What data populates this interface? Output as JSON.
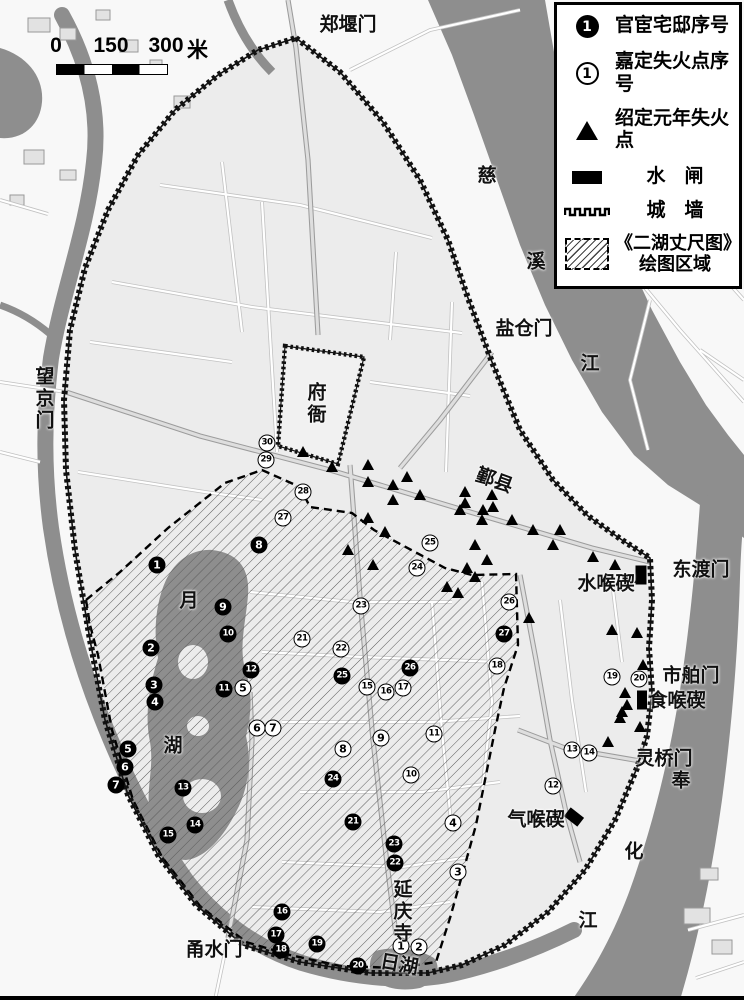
{
  "colors": {
    "ink": "#000000",
    "river": "#8e8e8e",
    "land": "#f8f8f8",
    "city": "#ececec",
    "label": "#111111"
  },
  "legend": {
    "items": [
      {
        "id": "official",
        "symbol": "filled-circle",
        "symbol_text": "1",
        "label": "官宦宅邸序号"
      },
      {
        "id": "jiading",
        "symbol": "open-circle",
        "symbol_text": "1",
        "label": "嘉定失火点序号"
      },
      {
        "id": "shaoding",
        "symbol": "triangle",
        "label": "绍定元年失火点"
      },
      {
        "id": "sluice",
        "symbol": "black-bar",
        "label": "水　闸"
      },
      {
        "id": "wall",
        "symbol": "crenellation",
        "label": "城　墙"
      },
      {
        "id": "map-area",
        "symbol": "hatched-box",
        "label": "《二湖丈尺图》",
        "label2": "绘图区域"
      }
    ]
  },
  "scalebar": {
    "ticks": [
      "0",
      "150",
      "300"
    ],
    "unit": "米"
  },
  "map": {
    "labels": [
      {
        "text": "郑堰门",
        "x": 348,
        "y": 26,
        "o": "h"
      },
      {
        "text": "望京门",
        "x": 42,
        "y": 399,
        "o": "v"
      },
      {
        "text": "慈",
        "x": 487,
        "y": 177,
        "o": "h"
      },
      {
        "text": "溪",
        "x": 536,
        "y": 263,
        "o": "h"
      },
      {
        "text": "江",
        "x": 590,
        "y": 365,
        "o": "h"
      },
      {
        "text": "盐仓门",
        "x": 524,
        "y": 330,
        "o": "h"
      },
      {
        "text": "府衙",
        "x": 314,
        "y": 404,
        "o": "v"
      },
      {
        "text": "鄞县",
        "x": 494,
        "y": 482,
        "o": "h",
        "rot": 20
      },
      {
        "text": "东渡门",
        "x": 701,
        "y": 571,
        "o": "h"
      },
      {
        "text": "水喉碶",
        "x": 606,
        "y": 585,
        "o": "h"
      },
      {
        "text": "市舶门",
        "x": 691,
        "y": 677,
        "o": "h"
      },
      {
        "text": "食喉碶",
        "x": 677,
        "y": 702,
        "o": "h"
      },
      {
        "text": "灵桥门",
        "x": 664,
        "y": 760,
        "o": "h"
      },
      {
        "text": "奉",
        "x": 681,
        "y": 782,
        "o": "h"
      },
      {
        "text": "化",
        "x": 634,
        "y": 853,
        "o": "h"
      },
      {
        "text": "江",
        "x": 588,
        "y": 922,
        "o": "h"
      },
      {
        "text": "气喉碶",
        "x": 536,
        "y": 821,
        "o": "h"
      },
      {
        "text": "月",
        "x": 189,
        "y": 602,
        "o": "h"
      },
      {
        "text": "湖",
        "x": 173,
        "y": 747,
        "o": "h"
      },
      {
        "text": "延庆寺",
        "x": 400,
        "y": 912,
        "o": "v"
      },
      {
        "text": "日湖",
        "x": 399,
        "y": 966,
        "o": "h",
        "rot": 10
      },
      {
        "text": "甬水门",
        "x": 214,
        "y": 951,
        "o": "h"
      }
    ],
    "official_residences": [
      {
        "n": 1,
        "x": 157,
        "y": 565
      },
      {
        "n": 2,
        "x": 151,
        "y": 648
      },
      {
        "n": 3,
        "x": 154,
        "y": 685
      },
      {
        "n": 4,
        "x": 155,
        "y": 702
      },
      {
        "n": 5,
        "x": 128,
        "y": 749
      },
      {
        "n": 6,
        "x": 125,
        "y": 767
      },
      {
        "n": 7,
        "x": 116,
        "y": 785
      },
      {
        "n": 8,
        "x": 259,
        "y": 545
      },
      {
        "n": 9,
        "x": 223,
        "y": 607
      },
      {
        "n": 10,
        "x": 228,
        "y": 634
      },
      {
        "n": 11,
        "x": 224,
        "y": 689
      },
      {
        "n": 12,
        "x": 251,
        "y": 670
      },
      {
        "n": 13,
        "x": 183,
        "y": 788
      },
      {
        "n": 14,
        "x": 195,
        "y": 825
      },
      {
        "n": 15,
        "x": 168,
        "y": 835
      },
      {
        "n": 16,
        "x": 282,
        "y": 912
      },
      {
        "n": 17,
        "x": 276,
        "y": 935
      },
      {
        "n": 18,
        "x": 281,
        "y": 950
      },
      {
        "n": 19,
        "x": 317,
        "y": 944
      },
      {
        "n": 20,
        "x": 358,
        "y": 966
      },
      {
        "n": 21,
        "x": 353,
        "y": 822
      },
      {
        "n": 22,
        "x": 395,
        "y": 863
      },
      {
        "n": 23,
        "x": 394,
        "y": 844
      },
      {
        "n": 24,
        "x": 333,
        "y": 779
      },
      {
        "n": 25,
        "x": 342,
        "y": 676
      },
      {
        "n": 26,
        "x": 410,
        "y": 668
      },
      {
        "n": 27,
        "x": 504,
        "y": 634
      }
    ],
    "jiading_fire_points": [
      {
        "n": 1,
        "x": 401,
        "y": 946
      },
      {
        "n": 2,
        "x": 419,
        "y": 947
      },
      {
        "n": 3,
        "x": 458,
        "y": 872
      },
      {
        "n": 4,
        "x": 453,
        "y": 823
      },
      {
        "n": 5,
        "x": 243,
        "y": 688
      },
      {
        "n": 6,
        "x": 257,
        "y": 728
      },
      {
        "n": 7,
        "x": 273,
        "y": 728
      },
      {
        "n": 8,
        "x": 343,
        "y": 749
      },
      {
        "n": 9,
        "x": 381,
        "y": 738
      },
      {
        "n": 10,
        "x": 411,
        "y": 775
      },
      {
        "n": 11,
        "x": 434,
        "y": 734
      },
      {
        "n": 12,
        "x": 553,
        "y": 786
      },
      {
        "n": 13,
        "x": 572,
        "y": 750
      },
      {
        "n": 14,
        "x": 589,
        "y": 753
      },
      {
        "n": 15,
        "x": 367,
        "y": 687
      },
      {
        "n": 16,
        "x": 386,
        "y": 692
      },
      {
        "n": 17,
        "x": 403,
        "y": 688
      },
      {
        "n": 18,
        "x": 497,
        "y": 666
      },
      {
        "n": 19,
        "x": 612,
        "y": 677
      },
      {
        "n": 20,
        "x": 639,
        "y": 679
      },
      {
        "n": 21,
        "x": 302,
        "y": 639
      },
      {
        "n": 22,
        "x": 341,
        "y": 649
      },
      {
        "n": 23,
        "x": 361,
        "y": 606
      },
      {
        "n": 24,
        "x": 417,
        "y": 568
      },
      {
        "n": 25,
        "x": 430,
        "y": 543
      },
      {
        "n": 26,
        "x": 509,
        "y": 602
      },
      {
        "n": 27,
        "x": 283,
        "y": 518
      },
      {
        "n": 28,
        "x": 303,
        "y": 492
      },
      {
        "n": 29,
        "x": 266,
        "y": 460
      },
      {
        "n": 30,
        "x": 267,
        "y": 443
      }
    ],
    "shaoding_fire_points": [
      [
        303,
        452
      ],
      [
        332,
        467
      ],
      [
        368,
        465
      ],
      [
        368,
        482
      ],
      [
        407,
        477
      ],
      [
        393,
        485
      ],
      [
        393,
        500
      ],
      [
        420,
        495
      ],
      [
        465,
        492
      ],
      [
        465,
        503
      ],
      [
        460,
        510
      ],
      [
        492,
        495
      ],
      [
        493,
        507
      ],
      [
        483,
        510
      ],
      [
        482,
        520
      ],
      [
        512,
        520
      ],
      [
        533,
        530
      ],
      [
        368,
        518
      ],
      [
        385,
        532
      ],
      [
        348,
        550
      ],
      [
        373,
        565
      ],
      [
        475,
        545
      ],
      [
        487,
        560
      ],
      [
        467,
        568
      ],
      [
        475,
        577
      ],
      [
        447,
        587
      ],
      [
        458,
        593
      ],
      [
        560,
        530
      ],
      [
        553,
        545
      ],
      [
        593,
        557
      ],
      [
        615,
        565
      ],
      [
        640,
        578
      ],
      [
        529,
        618
      ],
      [
        612,
        630
      ],
      [
        637,
        633
      ],
      [
        643,
        665
      ],
      [
        625,
        693
      ],
      [
        627,
        705
      ],
      [
        622,
        712
      ],
      [
        620,
        718
      ],
      [
        640,
        727
      ],
      [
        608,
        742
      ]
    ],
    "sluices": [
      {
        "x": 641,
        "y": 575,
        "w": 11,
        "h": 19,
        "rot": 0
      },
      {
        "x": 642,
        "y": 700,
        "w": 10,
        "h": 19,
        "rot": 0
      },
      {
        "x": 574,
        "y": 817,
        "w": 17,
        "h": 11,
        "rot": 38
      }
    ]
  }
}
